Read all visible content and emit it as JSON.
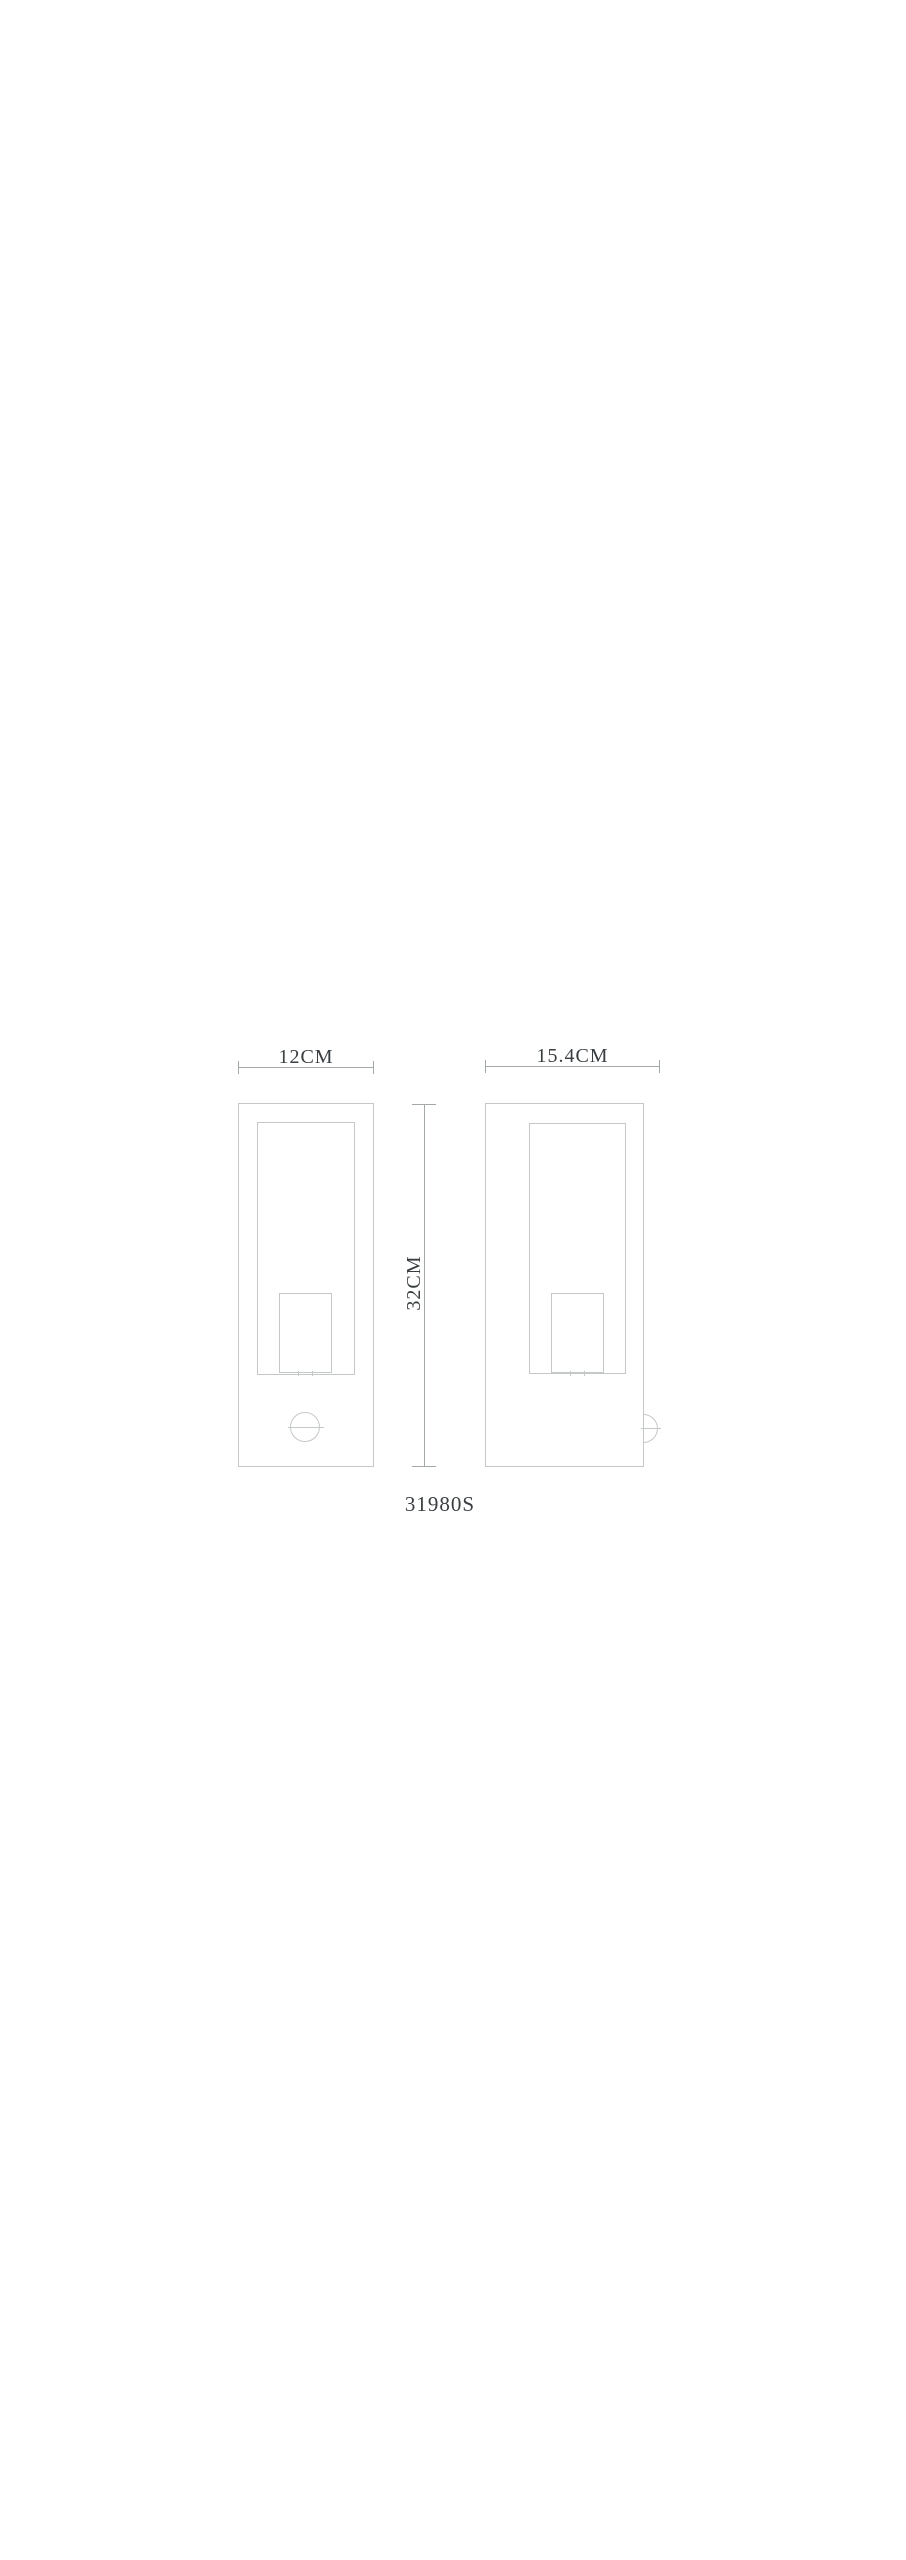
{
  "diagram": {
    "product_code": "31980S",
    "front_view": {
      "width_label": "12CM"
    },
    "side_view": {
      "width_label": "15.4CM"
    },
    "height_label": "32CM",
    "colors": {
      "background": "#ffffff",
      "outline": "#c5c8c8",
      "dimension_line": "#a3a8a8",
      "text": "#3a3e40"
    }
  }
}
